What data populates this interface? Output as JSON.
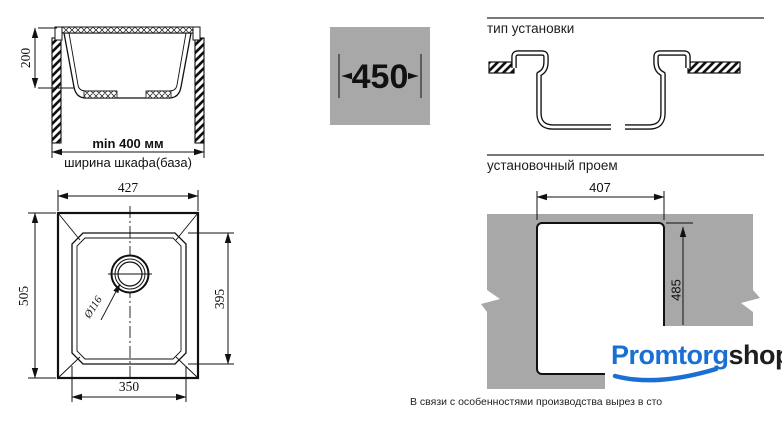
{
  "cabinet_section": {
    "depth": "200",
    "min_width": "min 400 мм",
    "width_label": "ширина шкафа(база)"
  },
  "cabinet_size": {
    "value": "450"
  },
  "installation": {
    "heading": "тип установки"
  },
  "opening": {
    "heading": "установочный проем",
    "width": "407",
    "height": "485"
  },
  "sink_top_view": {
    "overall_width": "427",
    "overall_depth": "505",
    "bowl_depth": "395",
    "bowl_width": "350",
    "drain_diameter": "Ø116"
  },
  "logo": {
    "primary": "Promtorg",
    "secondary": "shop"
  },
  "footnote": {
    "text": "В связи с особенностями производства вырез в сто"
  },
  "colors": {
    "panel_gray": "#a8a8a8",
    "logo_blue": "#1b6fd4",
    "line_black": "#111111"
  }
}
